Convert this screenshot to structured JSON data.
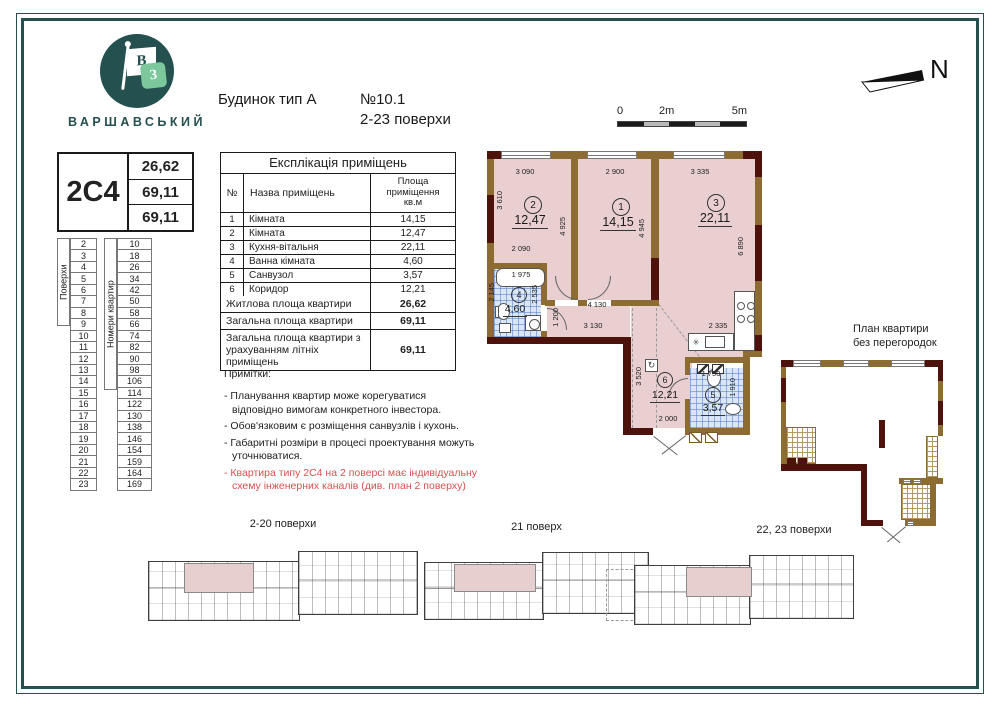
{
  "logo": {
    "brand": "ВАРШАВСЬКИЙ",
    "flag_letter": "В",
    "square_letter": "З"
  },
  "header": {
    "building_type": "Будинок тип А",
    "apartment_no": "№10.1",
    "floors_range": "2-23 поверхи"
  },
  "scale_bar": {
    "labels": [
      "0",
      "2m",
      "5m"
    ]
  },
  "compass": {
    "label": "N"
  },
  "apartment_card": {
    "type": "2С4",
    "living_area": "26,62",
    "total_area": "69,11",
    "total_area_summer": "69,11"
  },
  "floors_table": {
    "floors_header": "Поверхи",
    "apartments_header": "Номери квартир",
    "floors": [
      "2",
      "3",
      "4",
      "5",
      "6",
      "7",
      "8",
      "9",
      "10",
      "11",
      "12",
      "13",
      "14",
      "15",
      "16",
      "17",
      "18",
      "19",
      "20",
      "21",
      "22",
      "23"
    ],
    "apartments": [
      "10",
      "18",
      "26",
      "34",
      "42",
      "50",
      "58",
      "66",
      "74",
      "82",
      "90",
      "98",
      "106",
      "114",
      "122",
      "130",
      "138",
      "146",
      "154",
      "159",
      "164",
      "169"
    ]
  },
  "explication": {
    "title": "Експлікація приміщень",
    "col_no": "№",
    "col_name": "Назва приміщень",
    "col_area": "Площа приміщення кв.м",
    "rows": [
      {
        "no": "1",
        "name": "Кімната",
        "area": "14,15"
      },
      {
        "no": "2",
        "name": "Кімната",
        "area": "12,47"
      },
      {
        "no": "3",
        "name": "Кухня-вітальня",
        "area": "22,11"
      },
      {
        "no": "4",
        "name": "Ванна кімната",
        "area": "4,60"
      },
      {
        "no": "5",
        "name": "Санвузол",
        "area": "3,57"
      },
      {
        "no": "6",
        "name": "Коридор",
        "area": "12,21"
      }
    ],
    "summary": [
      {
        "label": "Житлова площа квартири",
        "value": "26,62"
      },
      {
        "label": "Загальна площа квартири",
        "value": "69,11"
      },
      {
        "label": "Загальна площа квартири з урахуванням літніх приміщень",
        "value": "69,11"
      }
    ]
  },
  "notes": {
    "title": "Примітки:",
    "items": [
      "- Планування квартир може корегуватися відповідно вимогам конкретного інвестора.",
      "- Обов'язковим є розміщення санвузлів і кухонь.",
      "- Габаритні розміри в процесі проектування можуть уточнюватися."
    ],
    "warning": "- Квартира типу 2С4 на 2 поверсі має індивідуальну схему інженерних каналів  (див. план 2 поверху)"
  },
  "plan": {
    "rooms": [
      {
        "n": "1",
        "area": "14,15"
      },
      {
        "n": "2",
        "area": "12,47"
      },
      {
        "n": "3",
        "area": "22,11"
      },
      {
        "n": "4",
        "area": "4,60"
      },
      {
        "n": "5",
        "area": "3,57"
      },
      {
        "n": "6",
        "area": "12,21"
      }
    ],
    "dims": {
      "top1": "3 090",
      "top2": "2 900",
      "top3": "3 335",
      "left1": "3 610",
      "mid1": "4 925",
      "mid2": "4 945",
      "right1": "6 890",
      "room2_w": "2 090",
      "tub": "1 975",
      "bath_h": "2 145",
      "bath_w": "2 535",
      "hall_h": "1 200",
      "hall_w1": "4 130",
      "hall_w2": "3 130",
      "kitchen_w": "2 335",
      "corr_h": "3 520",
      "wc_w": "1 750",
      "wc_h": "1 910",
      "entry_w": "2 000"
    }
  },
  "plan_no_partitions": {
    "title_line1": "План квартири",
    "title_line2": "без перегородок"
  },
  "mini_plans": [
    {
      "label": "2-20 поверхи"
    },
    {
      "label": "21 поверх"
    },
    {
      "label": "22, 23 поверхи"
    }
  ],
  "colors": {
    "accent_teal": "#24504f",
    "logo_green": "#7cc79c",
    "wall_brown": "#8d6c34",
    "wall_maroon": "#4d120b",
    "room_pink": "#e9cfcf",
    "tile_blue": "#d9e6f6",
    "warning_red": "#d94f4f"
  }
}
